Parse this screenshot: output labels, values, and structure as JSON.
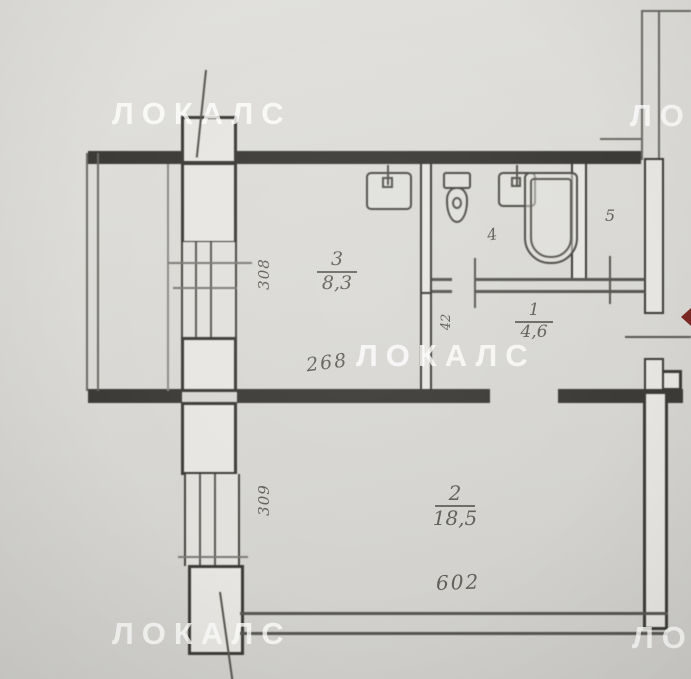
{
  "watermark": {
    "text": "ЛОКАЛС"
  },
  "rooms": {
    "room3": {
      "number": "3",
      "area": "8,3"
    },
    "room1": {
      "number": "1",
      "area": "4,6"
    },
    "room2": {
      "number": "2",
      "area": "18,5"
    },
    "room4": {
      "number": "4"
    },
    "room5": {
      "number": "5"
    }
  },
  "dimensions": {
    "upper_window": "308",
    "lower_window": "309",
    "room3_width": "268",
    "room2_width": "602",
    "hall_detail": "42"
  },
  "colors": {
    "paper": "#d9d8d4",
    "wall_dark": "#3c3b37",
    "line_thin": "#6b6a66",
    "label_ink": "#52504b",
    "watermark_white": "#ffffff",
    "entrance_arrow_red": "#7c2824"
  }
}
